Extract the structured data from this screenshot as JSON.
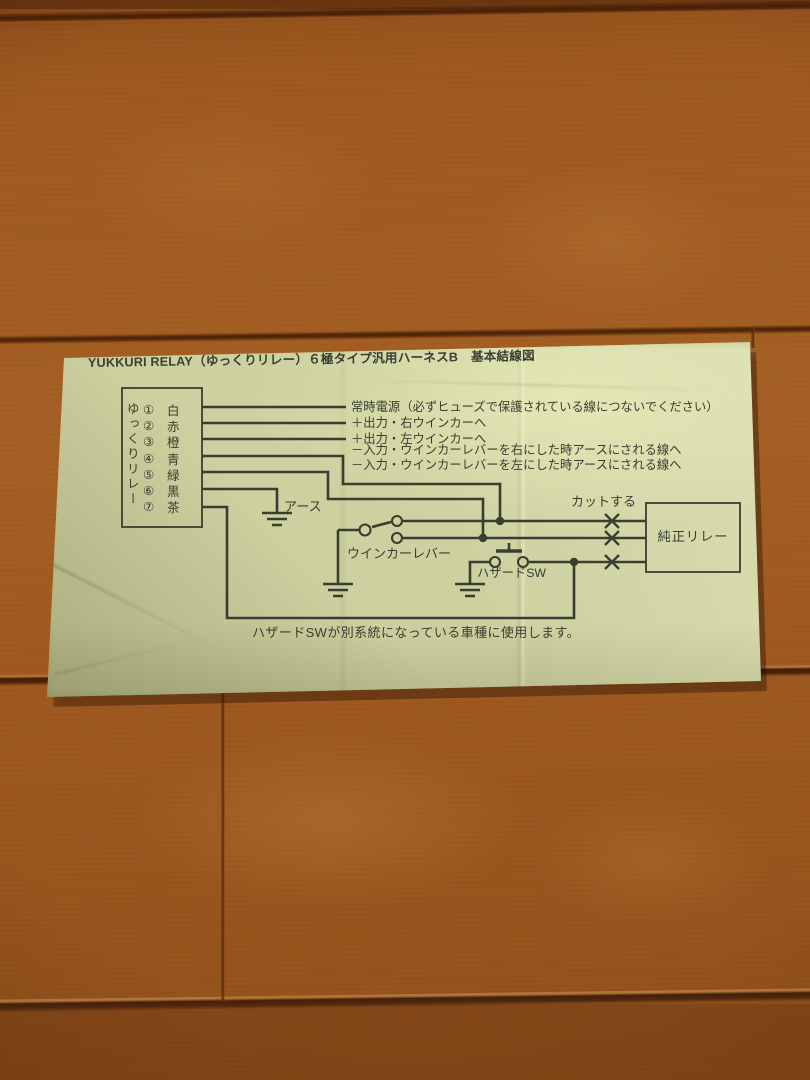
{
  "paper": {
    "title": "YUKKURI RELAY（ゆっくりリレー）６極タイプ汎用ハーネスB　基本結線図",
    "relay": {
      "vertical_label": "ゆっくりリレー",
      "terminals": [
        {
          "num": "①",
          "color": "白"
        },
        {
          "num": "②",
          "color": "赤"
        },
        {
          "num": "③",
          "color": "橙"
        },
        {
          "num": "④",
          "color": "青"
        },
        {
          "num": "⑤",
          "color": "緑"
        },
        {
          "num": "⑥",
          "color": "黒"
        },
        {
          "num": "⑦",
          "color": "茶"
        }
      ]
    },
    "wire_labels": [
      "常時電源（必ずヒューズで保護されている線につないでください）",
      "＋出力・右ウインカーへ",
      "＋出力・左ウインカーへ",
      "－入力・ウインカーレバーを右にした時アースにされる線へ",
      "－入力・ウインカーレバーを左にした時アースにされる線へ"
    ],
    "labels": {
      "earth": "アース",
      "winker_lever": "ウインカーレバー",
      "hazard_sw": "ハザードSW",
      "cut": "カットする",
      "oem_relay": "純正リレー"
    },
    "footnote": "ハザードSWが別系統になっている車種に使用します。",
    "colors": {
      "paper": "#cdd1a0",
      "ink": "#3a3e31"
    }
  }
}
